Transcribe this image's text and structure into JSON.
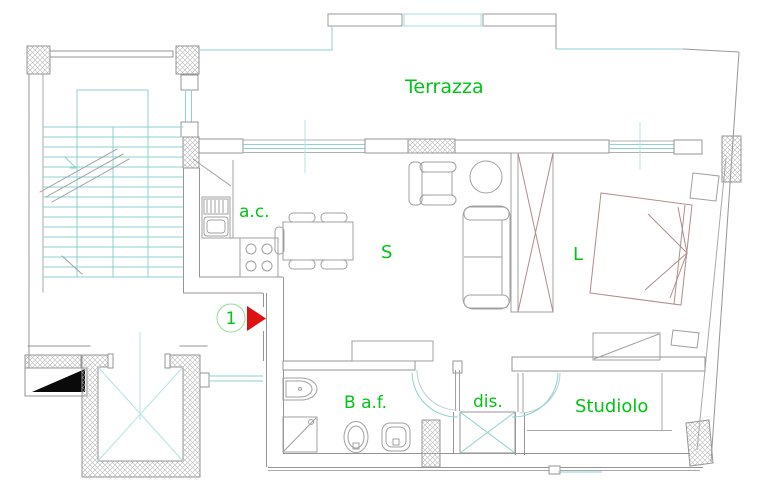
{
  "plan": {
    "rooms": {
      "terrazza": "Terrazza",
      "kitchenette": "a.c.",
      "living": "S",
      "bedroom": "L",
      "bathroom": "B a.f.",
      "hallway": "dis.",
      "study": "Studiolo"
    },
    "marker": {
      "number": "1"
    },
    "colors": {
      "label_green": "#00c414",
      "marker_circle_green": "#98dd98",
      "marker_red": "#dd1111",
      "line_cyan": "#8fd0d0",
      "line_cyan_light": "#b5e3e3",
      "wall_gray": "#969696",
      "furniture_brown": "#b18c8c",
      "section_black": "#0a0a0a"
    }
  }
}
